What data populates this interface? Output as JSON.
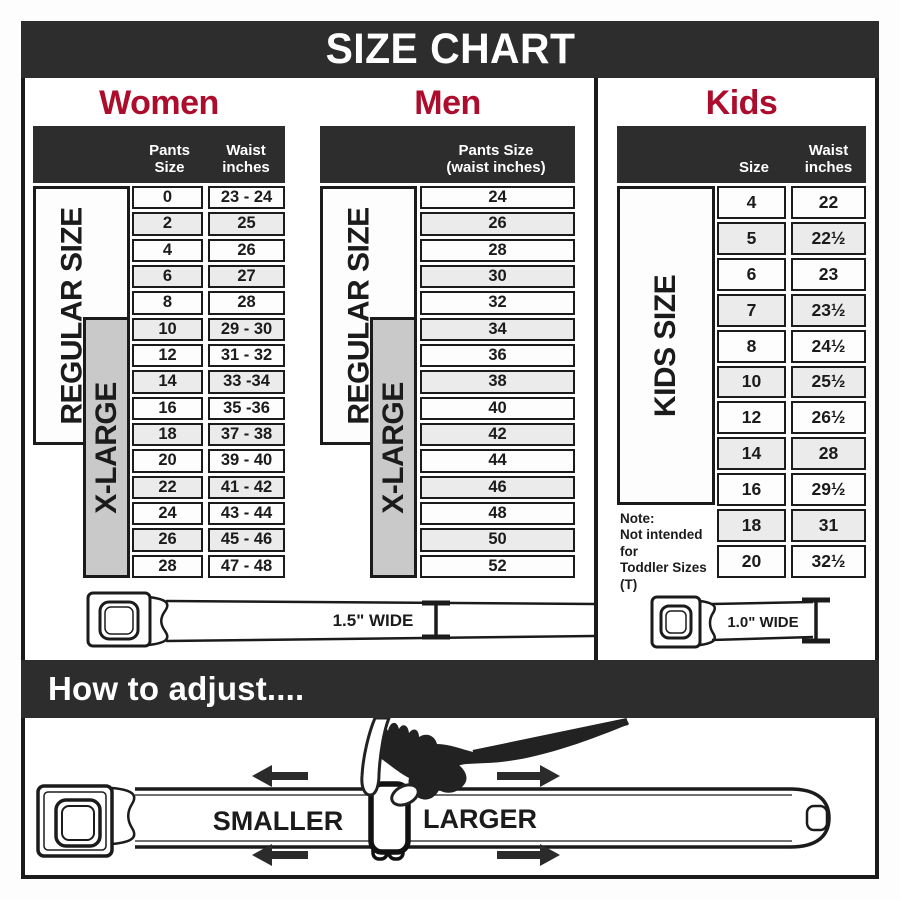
{
  "title": "SIZE CHART",
  "colors": {
    "accent_red": "#ad0d2d",
    "panel_dark": "#2d2d2e",
    "xlarge_gray": "#c9c9c9",
    "row_alt_gray": "#ebebeb",
    "line_black": "#1b1b1b"
  },
  "women": {
    "title": "Women",
    "col1_header": "Pants Size",
    "col2_header_1": "Waist",
    "col2_header_2": "inches",
    "regular_label": "REGULAR SIZE",
    "xlarge_label": "X-LARGE"
  },
  "men": {
    "title": "Men",
    "header_1": "Pants Size",
    "header_2": "(waist inches)",
    "regular_label": "REGULAR SIZE",
    "xlarge_label": "X-LARGE"
  },
  "kids": {
    "title": "Kids",
    "col1_header": "Size",
    "col2_header_1": "Waist",
    "col2_header_2": "inches",
    "side_label": "KIDS SIZE",
    "note_1": "Note:",
    "note_2": "Not intended for",
    "note_3": "Toddler Sizes (T)"
  },
  "belts": {
    "adult_width_label": "1.5\" WIDE",
    "kids_width_label": "1.0\" WIDE"
  },
  "how_to": {
    "title": "How to adjust....",
    "smaller": "SMALLER",
    "larger": "LARGER"
  },
  "chart_data": [
    {
      "type": "table",
      "title": "Women",
      "columns": [
        "Pants Size",
        "Waist inches"
      ],
      "rows": [
        [
          "0",
          "23 - 24"
        ],
        [
          "2",
          "25"
        ],
        [
          "4",
          "26"
        ],
        [
          "6",
          "27"
        ],
        [
          "8",
          "28"
        ],
        [
          "10",
          "29 - 30"
        ],
        [
          "12",
          "31 - 32"
        ],
        [
          "14",
          "33 -34"
        ],
        [
          "16",
          "35 -36"
        ],
        [
          "18",
          "37 - 38"
        ],
        [
          "20",
          "39 - 40"
        ],
        [
          "22",
          "41 - 42"
        ],
        [
          "24",
          "43 - 44"
        ],
        [
          "26",
          "45 - 46"
        ],
        [
          "28",
          "47 - 48"
        ]
      ],
      "groups": {
        "REGULAR SIZE": "pants 0-18",
        "X-LARGE": "pants 10-28"
      }
    },
    {
      "type": "table",
      "title": "Men",
      "columns": [
        "Pants Size (waist inches)"
      ],
      "rows": [
        [
          "24"
        ],
        [
          "26"
        ],
        [
          "28"
        ],
        [
          "30"
        ],
        [
          "32"
        ],
        [
          "34"
        ],
        [
          "36"
        ],
        [
          "38"
        ],
        [
          "40"
        ],
        [
          "42"
        ],
        [
          "44"
        ],
        [
          "46"
        ],
        [
          "48"
        ],
        [
          "50"
        ],
        [
          "52"
        ]
      ],
      "groups": {
        "REGULAR SIZE": "24-36",
        "X-LARGE": "34-52"
      }
    },
    {
      "type": "table",
      "title": "Kids",
      "columns": [
        "Size",
        "Waist inches"
      ],
      "rows": [
        [
          "4",
          "22"
        ],
        [
          "5",
          "22½"
        ],
        [
          "6",
          "23"
        ],
        [
          "7",
          "23½"
        ],
        [
          "8",
          "24½"
        ],
        [
          "10",
          "25½"
        ],
        [
          "12",
          "26½"
        ],
        [
          "14",
          "28"
        ],
        [
          "16",
          "29½"
        ],
        [
          "18",
          "31"
        ],
        [
          "20",
          "32½"
        ]
      ],
      "groups": {
        "KIDS SIZE": "sizes 4-20"
      }
    }
  ]
}
